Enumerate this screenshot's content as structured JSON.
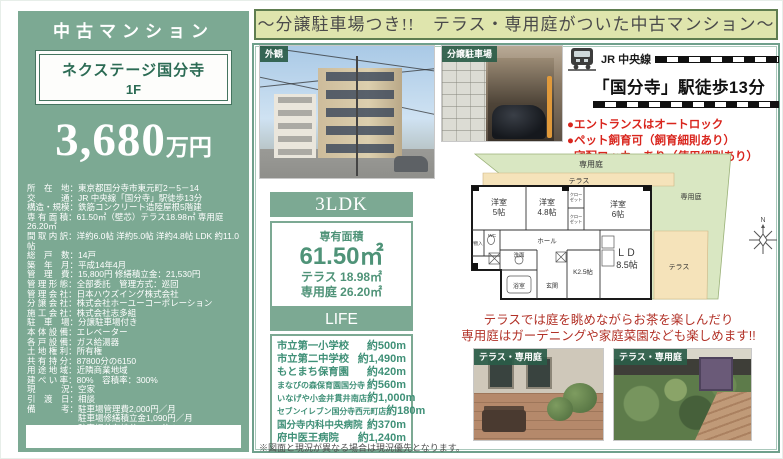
{
  "colors": {
    "panel_green": "#7ca993",
    "deep_green_text": "#2b6b54",
    "banner_bg": "#dfe5ad",
    "banner_border": "#5f7d50",
    "accent_red": "#d9251d",
    "life_green": "#3f9077",
    "plan_garden_green": "#d9e7c2",
    "plan_terrace_tan": "#f5e3ba"
  },
  "left": {
    "category": "中古マンション",
    "name_line1": "ネクステージ国分寺",
    "name_line2": "1F",
    "price_number": "3,680",
    "price_unit": "万円",
    "details": [
      "所　在　地：東京都国分寺市東元町2－5－14",
      "交　　　通：JR 中央線「国分寺」駅徒歩13分",
      "構造・規模：鉄筋コンクリート造陸屋根5階建",
      "専 有 面 積：61.50㎡（壁芯）テラス18.98㎡ 専用庭26.20㎡",
      "間 取 内 訳：洋約6.0帖 洋約5.0帖 洋約4.8帖 LDK 約11.0帖",
      "総　戸　数：14戸",
      "築　年　月：平成14年4月",
      "管　理　費：15,800円 修繕積立金：21,530円",
      "管 理 形 態：全部委託　管理方式：巡回",
      "管 理 会 社：日本ハウズイング株式会社",
      "分 譲 会 社：株式会社ホーユーコーポレーション",
      "施 工 会 社：株式会社志多組",
      "駐　車　場：分譲駐車場付き",
      "本 体 設 備：エレベーター",
      "各 戸 設 備：ガス給湯器",
      "土 地 権 利：所有権",
      "共 有 持 分：87800分の6150",
      "用 途 地 域：近隣商業地域",
      "建 ぺ い 率：80%　容積率：300%",
      "現　　　況：空家",
      "引　渡　日：相談",
      "備　　　考：駐車場管理費2,000円／月",
      "　　　　　　駐車場修繕積立金1,090円／月",
      "　　　　　　駐車場共有持分87800分の1526",
      "　　　　　　司法書士売主指定"
    ]
  },
  "banner": {
    "text": "～分譲駐車場つき!!　テラス・専用庭がついた中古マンション～"
  },
  "photos": {
    "exterior_label": "外観",
    "parking_label": "分譲駐車場",
    "terrace1_label": "テラス・専用庭",
    "terrace2_label": "テラス・専用庭"
  },
  "access": {
    "line_name": "JR 中央線",
    "station": "「国分寺」駅徒歩13分",
    "features": [
      "●エントランスはオートロック",
      "●ペット飼育可（飼育細則あり）",
      "●宅配ロッカーあり（使用細則あり）"
    ]
  },
  "unit": {
    "layout": "3LDK",
    "area_label": "専有面積",
    "area_value": "61.50㎡",
    "terrace": "テラス 18.98㎡",
    "garden": "専用庭 26.20㎡"
  },
  "life": {
    "title": "LIFE INFORMATION",
    "items": [
      {
        "name": "市立第一小学校",
        "distance": "約500m"
      },
      {
        "name": "市立第二中学校",
        "distance": "約1,490m"
      },
      {
        "name": "もとまち保育園",
        "distance": "約420m"
      },
      {
        "name": "まなびの森保育園国分寺",
        "distance": "約560m"
      },
      {
        "name": "いなげや小金井貫井南店",
        "distance": "約1,000m"
      },
      {
        "name": "セブンイレブン国分寺西元町店",
        "distance": "約180m"
      },
      {
        "name": "国分寺内科中央病院",
        "distance": "約370m"
      },
      {
        "name": "府中医王病院",
        "distance": "約1,240m"
      }
    ]
  },
  "floorplan": {
    "garden_top": "専用庭",
    "terrace_top": "テラス",
    "garden_right": "専用庭",
    "terrace_right": "テラス",
    "room1_l1": "洋室",
    "room1_l2": "5帖",
    "room2_l1": "洋室",
    "room2_l2": "4.8帖",
    "room3_l1": "洋室",
    "room3_l2": "6帖",
    "closet1_l1": "クロー",
    "closet1_l2": "ゼット",
    "closet2_l1": "クロー",
    "closet2_l2": "ゼット",
    "monoire": "物入",
    "wc": "WC",
    "hall": "ホール",
    "senmen": "洗面",
    "bath": "浴室",
    "genkan": "玄関",
    "kitchen": "K2.5帖",
    "ld_l1": "ＬＤ",
    "ld_l2": "8.5帖",
    "compass_n": "N"
  },
  "caption": {
    "line1": "テラスでは庭を眺めながらお茶を楽しんだり",
    "line2": "専用庭はガーデニングや家庭菜園なども楽しめます!!"
  },
  "note": "※図面と現況が異なる場合は現況優先となります。"
}
